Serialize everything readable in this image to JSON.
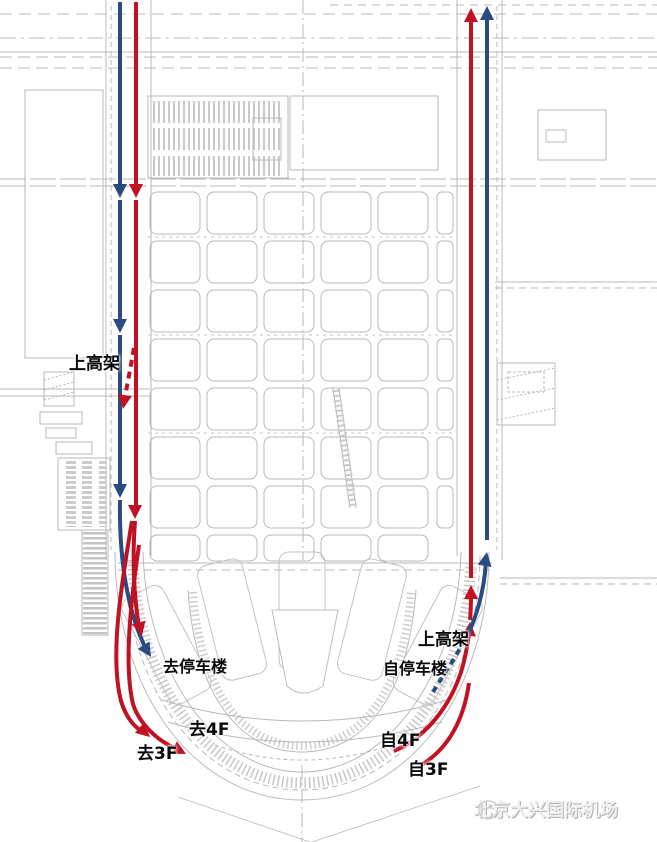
{
  "colors": {
    "route_red": "#c01222",
    "route_blue": "#2a4a82",
    "map_gray": "#b6b6b6",
    "label_black": "#0a0a0a",
    "logo_gray": "#efefef"
  },
  "labels": {
    "left_viaduct": "上高架",
    "to_parking": "去停车楼",
    "to_4f": "去4F",
    "to_3f": "去3F",
    "right_viaduct": "上高架",
    "from_parking": "自停车楼",
    "from_4f": "自4F",
    "from_3f": "自3F"
  },
  "branding": {
    "airport_name": "北京大兴国际机场",
    "logo_icon": "phoenix-logo-icon"
  }
}
